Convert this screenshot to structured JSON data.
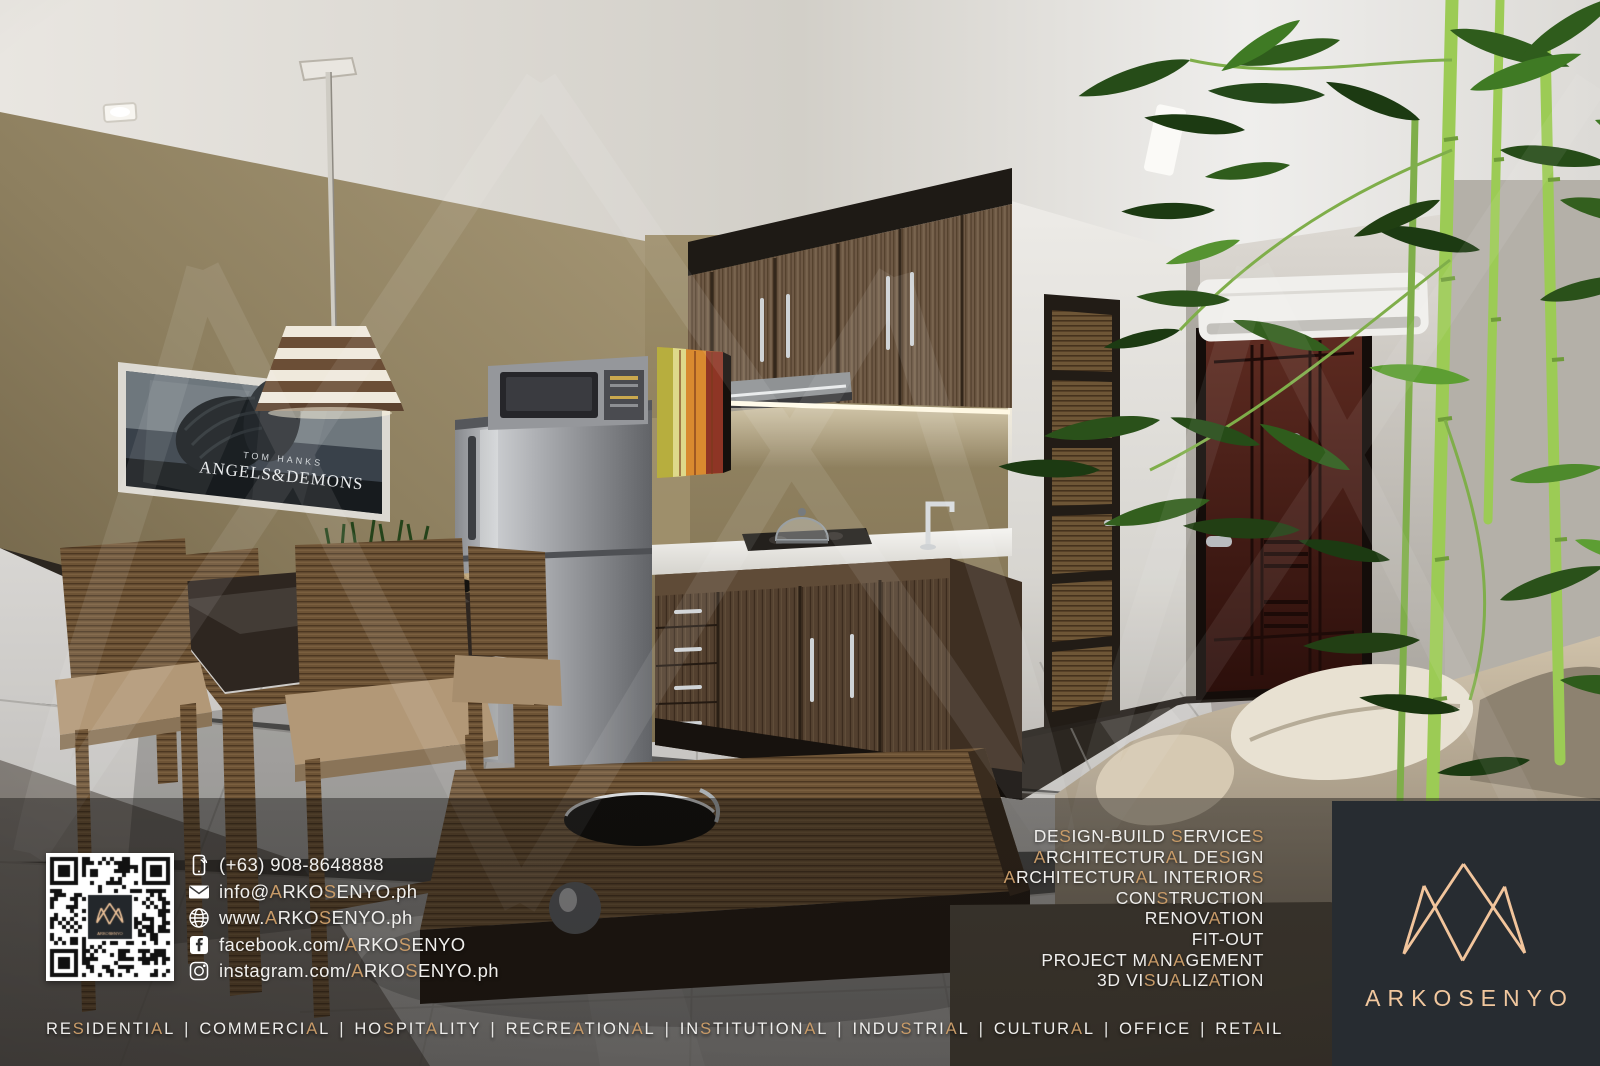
{
  "accent_color": "#c89b68",
  "brand": {
    "name": "ARKOSENYO",
    "logo_color": "#f2c59c",
    "box_color": "#272c31"
  },
  "contact": {
    "items": [
      {
        "icon": "phone-icon",
        "text": "(+63) 908-8648888"
      },
      {
        "icon": "mail-icon",
        "text": "info@ARKOSENYO.ph"
      },
      {
        "icon": "globe-icon",
        "text": "www.ARKOSENYO.ph"
      },
      {
        "icon": "facebook-icon",
        "text": "facebook.com/ARKOSENYO"
      },
      {
        "icon": "instagram-icon",
        "text": "instagram.com/ARKOSENYO.ph"
      }
    ],
    "qr_label": "ARKOSENYO"
  },
  "services": {
    "items": [
      "DESIGN-BUILD SERVICES",
      "ARCHITECTURAL DESIGN",
      "ARCHITECTURAL INTERIORS",
      "CONSTRUCTION",
      "RENOVATION",
      "FIT-OUT",
      "PROJECT MANAGEMENT",
      "3D VISUALIZATION"
    ]
  },
  "sectors": {
    "separator": "|",
    "items": [
      "RESIDENTIAL",
      "COMMERCIAL",
      "HOSPITALITY",
      "RECREATIONAL",
      "INSTITUTIONAL",
      "INDUSTRIAL",
      "CULTURAL",
      "OFFICE",
      "RETAIL"
    ]
  },
  "poster": {
    "line1": "TOM HANKS",
    "line2": "ANGELS&DEMONS"
  }
}
